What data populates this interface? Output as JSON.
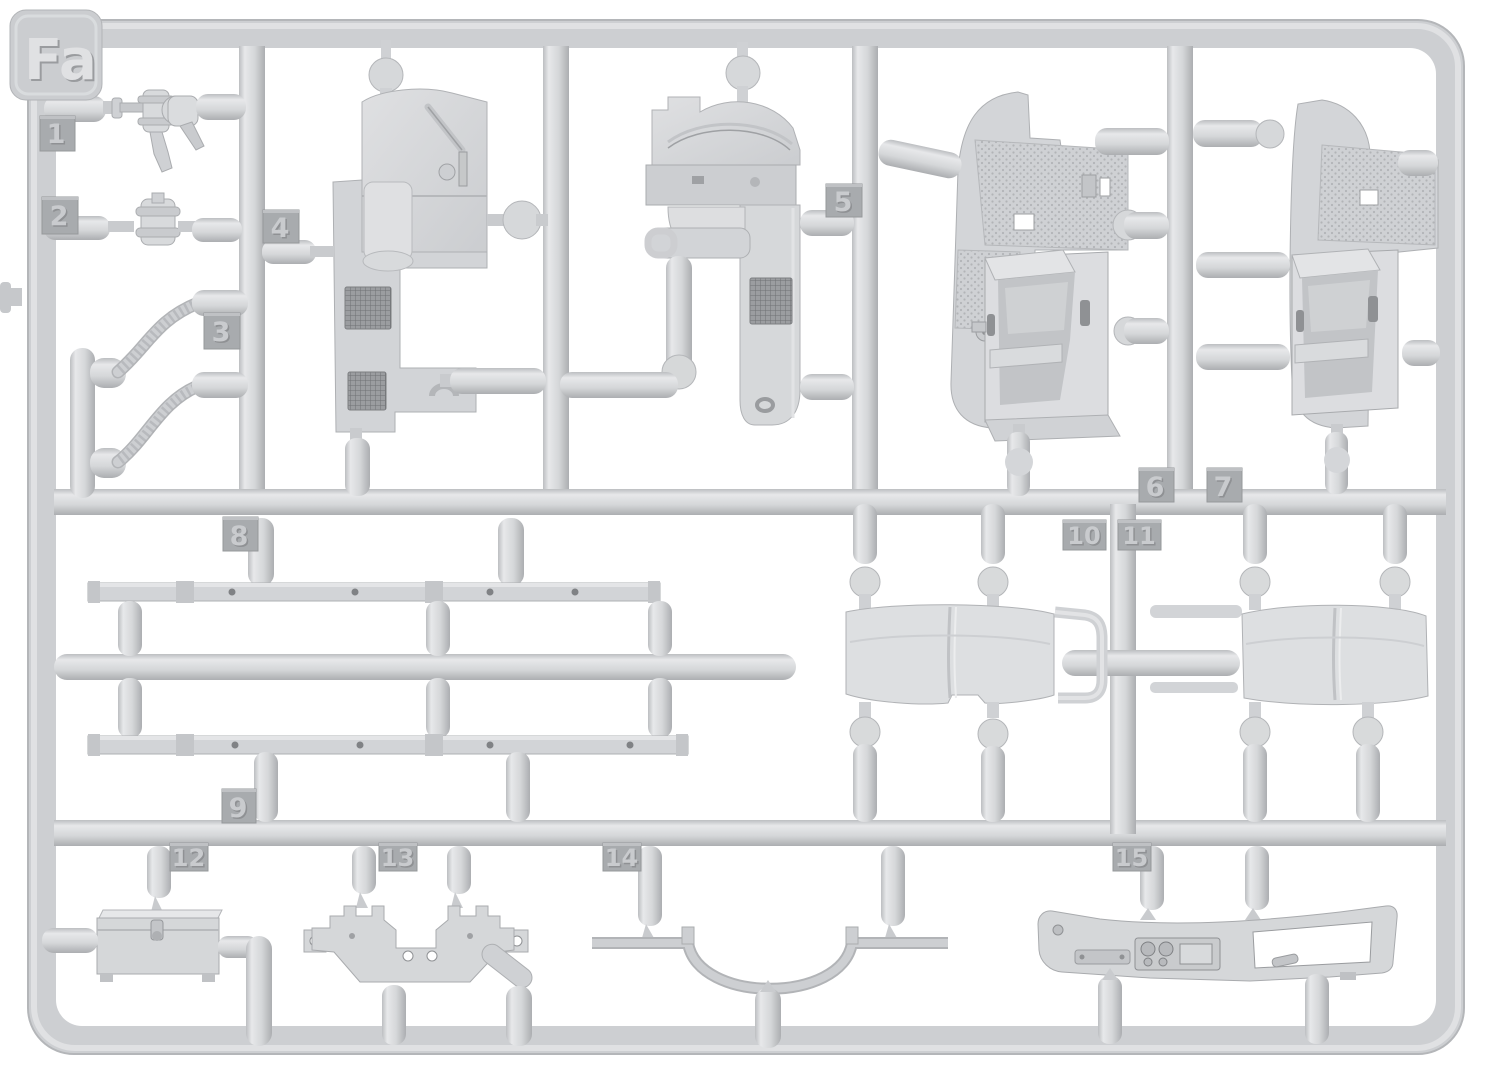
{
  "sprue": {
    "id": "Fa",
    "part_numbers": [
      "1",
      "2",
      "3",
      "4",
      "5",
      "6",
      "7",
      "8",
      "9",
      "10",
      "11",
      "12",
      "13",
      "14",
      "15"
    ]
  },
  "palette": {
    "background": "#ffffff",
    "plastic": "#d4d6d9",
    "plastic_highlight": "#e8e9eb",
    "plastic_shadow": "#aeb0b3",
    "panel_fill": "#d6d8da",
    "tag_fill": "#a8abae",
    "tag_text_light": "#c9cbce",
    "tag_text_dark": "#8f9194",
    "mesh_grille": "#9b9da0"
  }
}
